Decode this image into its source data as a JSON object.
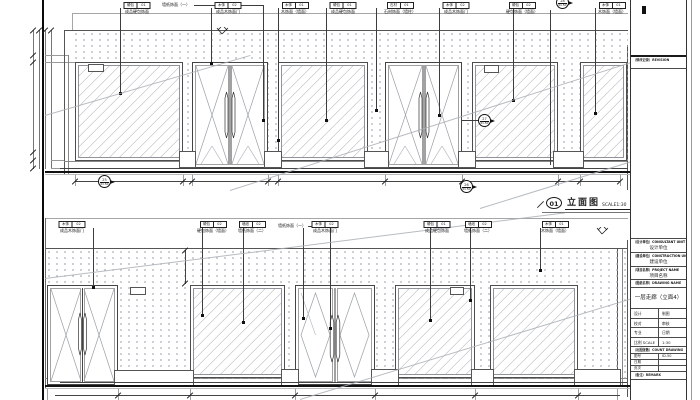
{
  "drawing": {
    "elevation_label": {
      "num": "01",
      "title": "立面图",
      "scale": "SCALE1:30"
    },
    "top_elevation": {
      "tags": [
        {
          "a": "硬包",
          "b": "01",
          "label": "成品硬包饰面"
        },
        {
          "label": "墙纸饰面（一）"
        },
        {
          "a": "木饰",
          "b": "02",
          "label": "成品木饰面门"
        },
        {
          "a": "木饰",
          "b": "01",
          "label": "木饰面（墙面）"
        },
        {
          "a": "硬包",
          "b": "01",
          "label": "成品硬包饰面"
        },
        {
          "a": "石材",
          "b": "01",
          "label": "石材饰面（墙柱）"
        },
        {
          "a": "木饰",
          "b": "02",
          "label": "成品木饰面门"
        },
        {
          "a": "硬包",
          "b": "02",
          "label": "硬包饰面（墙面）"
        },
        {
          "a": "木饰",
          "b": "01",
          "label": "木饰面（墙面）"
        }
      ],
      "details": [
        {
          "num": "25",
          "sheet": "ID-50"
        },
        {
          "num": "26",
          "sheet": "ID-50"
        },
        {
          "num": "27",
          "sheet": "ID-50"
        },
        {
          "num": "28",
          "sheet": "ID-50"
        }
      ]
    },
    "bottom_elevation": {
      "tags": [
        {
          "a": "木饰",
          "b": "02",
          "label": "成品木饰面门"
        },
        {
          "a": "硬包",
          "b": "02",
          "label": "硬包饰面（墙面）"
        },
        {
          "a": "墙纸",
          "b": "02",
          "label": "墙纸饰面（二）"
        },
        {
          "label": "墙纸饰面（一）"
        },
        {
          "a": "木饰",
          "b": "02",
          "label": "成品木饰面门"
        },
        {
          "a": "硬包",
          "b": "01",
          "label": "成品硬包饰面"
        },
        {
          "a": "墙纸",
          "b": "02",
          "label": "墙纸饰面（二）"
        },
        {
          "a": "木饰",
          "b": "01",
          "label": "木饰面（墙面）"
        }
      ]
    },
    "title_block": {
      "revision_header": "（修改记录）REVISION",
      "consultant_en": "（设计单位）CONSULTANT UNIT",
      "consultant_cn": "设计单位",
      "construction_en": "（建设单位）CONSTRUCTION UNIT",
      "construction_cn": "建设单位",
      "project_en": "（项目名称）PROJECT NAME",
      "project_cn": "项目名称",
      "drawing_name_header": "（图纸名称）DRAWING NAME",
      "drawing_name": "一层走廊（立面4）",
      "staff": [
        [
          "设计",
          "制图"
        ],
        [
          "校对",
          "审核"
        ],
        [
          "专业",
          "日期"
        ],
        [
          "比例 SCALE",
          "1:30"
        ]
      ],
      "count_header": "（出图张数）COUNT DRAWING",
      "info": [
        [
          "图号",
          "ID-50"
        ],
        [
          "日期",
          ""
        ],
        [
          "页次",
          ""
        ]
      ],
      "remark_header": "（备注）REMARK"
    }
  }
}
